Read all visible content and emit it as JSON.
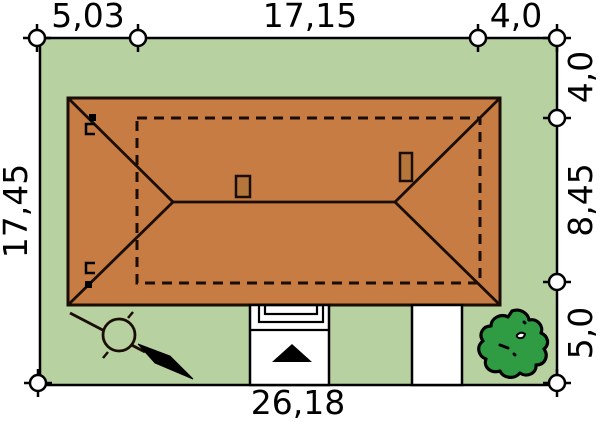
{
  "plan_title": "house-site-plan",
  "dimensions": {
    "top": [
      "5,03",
      "17,15",
      "4,0"
    ],
    "right": [
      "4,0",
      "8,45",
      "5,0"
    ],
    "left": [
      "17,45"
    ],
    "bottom": [
      "26,18"
    ]
  },
  "colors": {
    "plot_green": "#b8d1a1",
    "roof_orange": "#c67c42",
    "chimney_brown": "#b5763c",
    "tree_green": "#2f9b43",
    "outline_dark": "#1a0d05",
    "path_white": "#ffffff",
    "marker_black": "#000000"
  }
}
